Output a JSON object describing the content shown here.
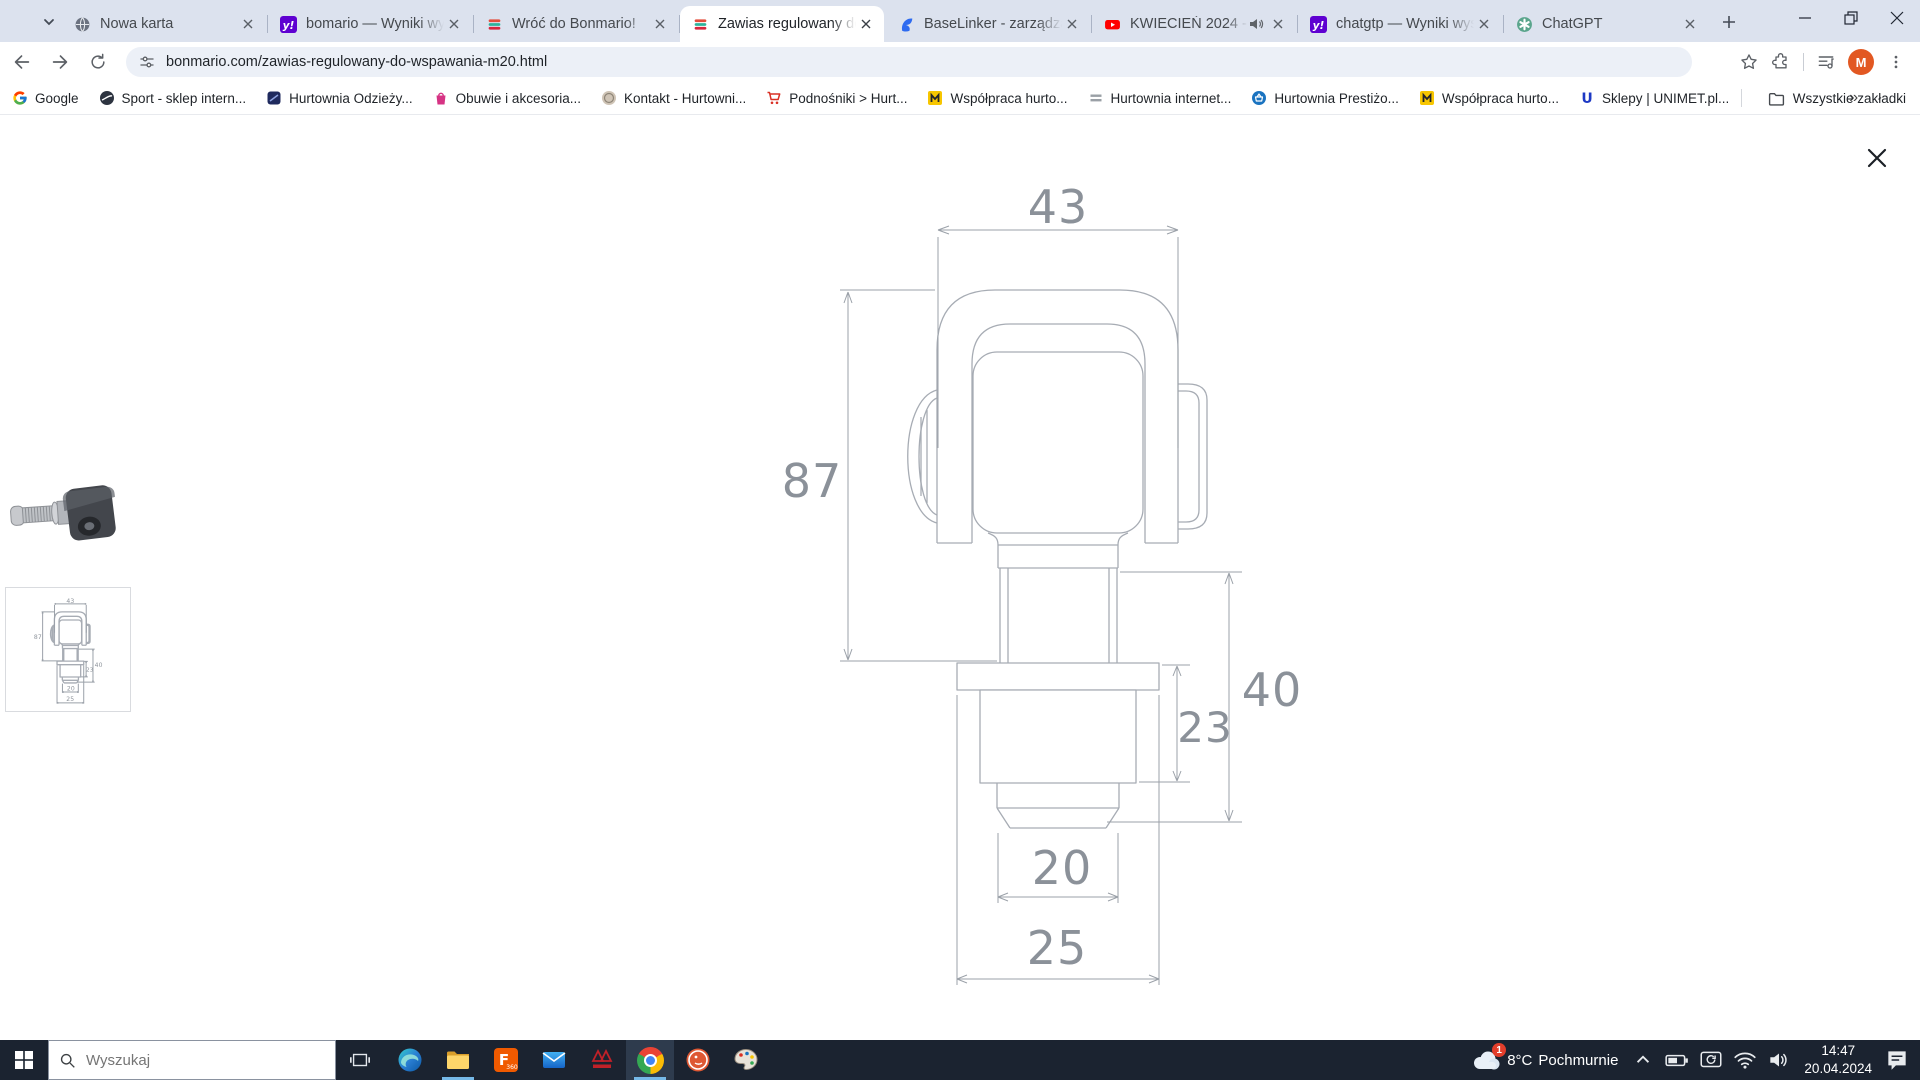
{
  "browser": {
    "tabs": [
      {
        "label": "Nowa karta"
      },
      {
        "label": "bomario — Wyniki wyszu"
      },
      {
        "label": "Wróć do Bonmario!"
      },
      {
        "label": "Zawias regulowany do w"
      },
      {
        "label": "BaseLinker - zarządzanie"
      },
      {
        "label": "KWIECIEŃ 2024 - NA"
      },
      {
        "label": "chatgtp — Wyniki wyszu"
      },
      {
        "label": "ChatGPT"
      }
    ],
    "toolbar": {
      "url": "bonmario.com/zawias-regulowany-do-wspawania-m20.html",
      "profile_initial": "M"
    },
    "bookmarks_bar": {
      "items": [
        {
          "label": "Google"
        },
        {
          "label": "Sport - sklep intern..."
        },
        {
          "label": "Hurtownia Odzieży..."
        },
        {
          "label": "Obuwie i akcesoria..."
        },
        {
          "label": "Kontakt - Hurtowni..."
        },
        {
          "label": "Podnośniki > Hurt..."
        },
        {
          "label": "Współpraca hurto..."
        },
        {
          "label": "Hurtownia internet..."
        },
        {
          "label": "Hurtownia Prestiżo..."
        },
        {
          "label": "Współpraca hurto..."
        },
        {
          "label": "Sklepy | UNIMET.pl..."
        }
      ],
      "overflow_glyph": "»",
      "all_bookmarks_label": "Wszystkie zakładki"
    }
  },
  "drawing": {
    "dim_top_width": "43",
    "dim_total_height": "87",
    "dim_stud_length": "40",
    "dim_nut_height": "23",
    "dim_thread_dia": "20",
    "dim_plate_width": "25"
  },
  "taskbar": {
    "search_placeholder": "Wyszukaj",
    "weather": {
      "badge": "1",
      "temperature": "8°C",
      "condition": "Pochmurnie"
    },
    "clock": {
      "time": "14:47",
      "date": "20.04.2024"
    }
  },
  "colors": {
    "tab_strip_bg": "#dce2ee",
    "omnibox_bg": "#ecf0f7",
    "taskbar_bg": "#1b2330",
    "taskbar_underline": "#76b9e8",
    "avatar_orange": "#e25822",
    "yahoo_purple": "#5f01d1",
    "youtube_red": "#ff0000",
    "drawing_line_gray": "#a7acb4",
    "drawing_text_gray": "#8b9199"
  }
}
